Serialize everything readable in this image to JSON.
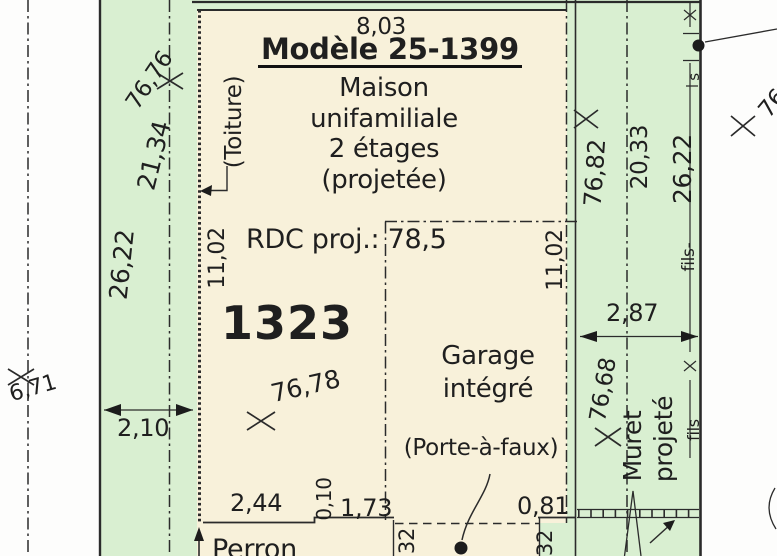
{
  "colors": {
    "lot_green": "#d9efd1",
    "building_beige": "#f8f1da",
    "ink": "#2b2b2b"
  },
  "title": {
    "model": "Modèle 25-1399",
    "house_lines": [
      "Maison",
      "unifamiliale",
      "2 étages",
      "(projetée)"
    ],
    "rdc": "RDC proj.: 78,5",
    "lot_number": "1323"
  },
  "labels": {
    "roof": "(Toiture)",
    "garage_lines": [
      "Garage",
      "intégré"
    ],
    "cantilever": "(Porte-à-faux)",
    "porch": "Perron",
    "wall_lines": [
      "Muret",
      "projeté"
    ],
    "fence_label": "fils-",
    "fence_label_2": "fils",
    "fence_letter": "s"
  },
  "dimensions": {
    "top_width": "8,03",
    "left_wall": "11,02",
    "right_wall": "11,02",
    "left_boundary_1": "21,34",
    "left_boundary_2": "26,22",
    "left_setback": "2,10",
    "right_boundary_1": "20,33",
    "fence_length": "26,22",
    "right_setback": "2,87",
    "bottom_left": "2,44",
    "bottom_step": "0,10",
    "bottom_mid": "1,73",
    "bottom_right": "0,81",
    "cantilever_left": "32",
    "cantilever_right": "32"
  },
  "elevations": {
    "northwest": "76,76",
    "northeast": "76,82",
    "house_floor": "76,78",
    "east": "76,68",
    "far_right": "76",
    "southwest": "6,71"
  }
}
